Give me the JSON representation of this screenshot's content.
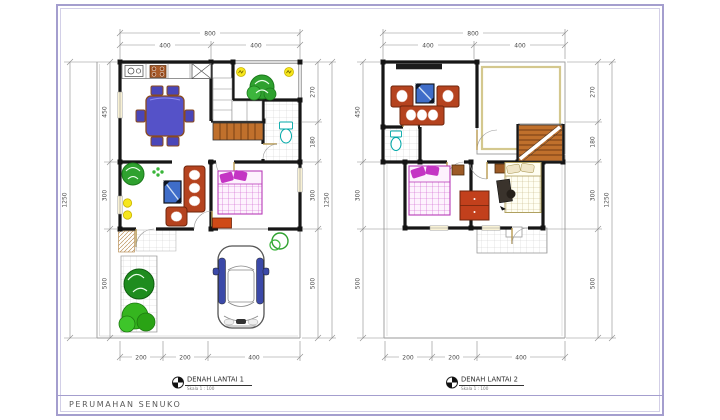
{
  "sheet": {
    "project_label": "PERUMAHAN SENUKO",
    "colors": {
      "sheet_border": "#a49ece",
      "walls": "#161616",
      "sofa": "#b5431f",
      "dining_table": "#5552c8",
      "tv": "#3f6dc9",
      "bed": "#c435c4",
      "plant": "#2fa12f",
      "lamp": "#f7e71c",
      "stairs": "#c0702c",
      "car_accent": "#3b49a8",
      "toilet": "#00a8a8"
    }
  },
  "plan1": {
    "title": "DENAH LANTAI 1",
    "scale_label": "Skala 1 : 100",
    "dims": {
      "top_total": "800",
      "top_segments": [
        "400",
        "400"
      ],
      "left_total": "1250",
      "left_segments": [
        "450",
        "300",
        "500"
      ],
      "right_total": "1250",
      "right_segments": [
        "270",
        "180",
        "300",
        "500"
      ],
      "bottom_segments": [
        "200",
        "200",
        "400"
      ]
    },
    "visible_items": [
      "kitchen counter with sink and stove",
      "dining table with chairs",
      "closets",
      "rear garden plant",
      "wall lamps",
      "staircase",
      "bathroom with toilet",
      "living room plant",
      "tv",
      "sofa set",
      "bed",
      "dresser",
      "terrace tiles",
      "doormat",
      "garden trees",
      "car in carport",
      "shrub"
    ]
  },
  "plan2": {
    "title": "DENAH LANTAI 2",
    "scale_label": "Skala 1 : 100",
    "dims": {
      "top_total": "800",
      "top_segments": [
        "400",
        "400"
      ],
      "left_segments": [
        "450",
        "300",
        "500"
      ],
      "right_total": "1250",
      "right_segments": [
        "270",
        "180",
        "300",
        "500"
      ],
      "bottom_segments": [
        "200",
        "200",
        "400"
      ]
    },
    "visible_items": [
      "tv console",
      "two armchairs",
      "tv",
      "sofa",
      "bathroom with toilet",
      "staircase",
      "open void area",
      "bed left bedroom",
      "wardrobe",
      "bed right bedroom",
      "desk",
      "balcony tiles"
    ]
  }
}
